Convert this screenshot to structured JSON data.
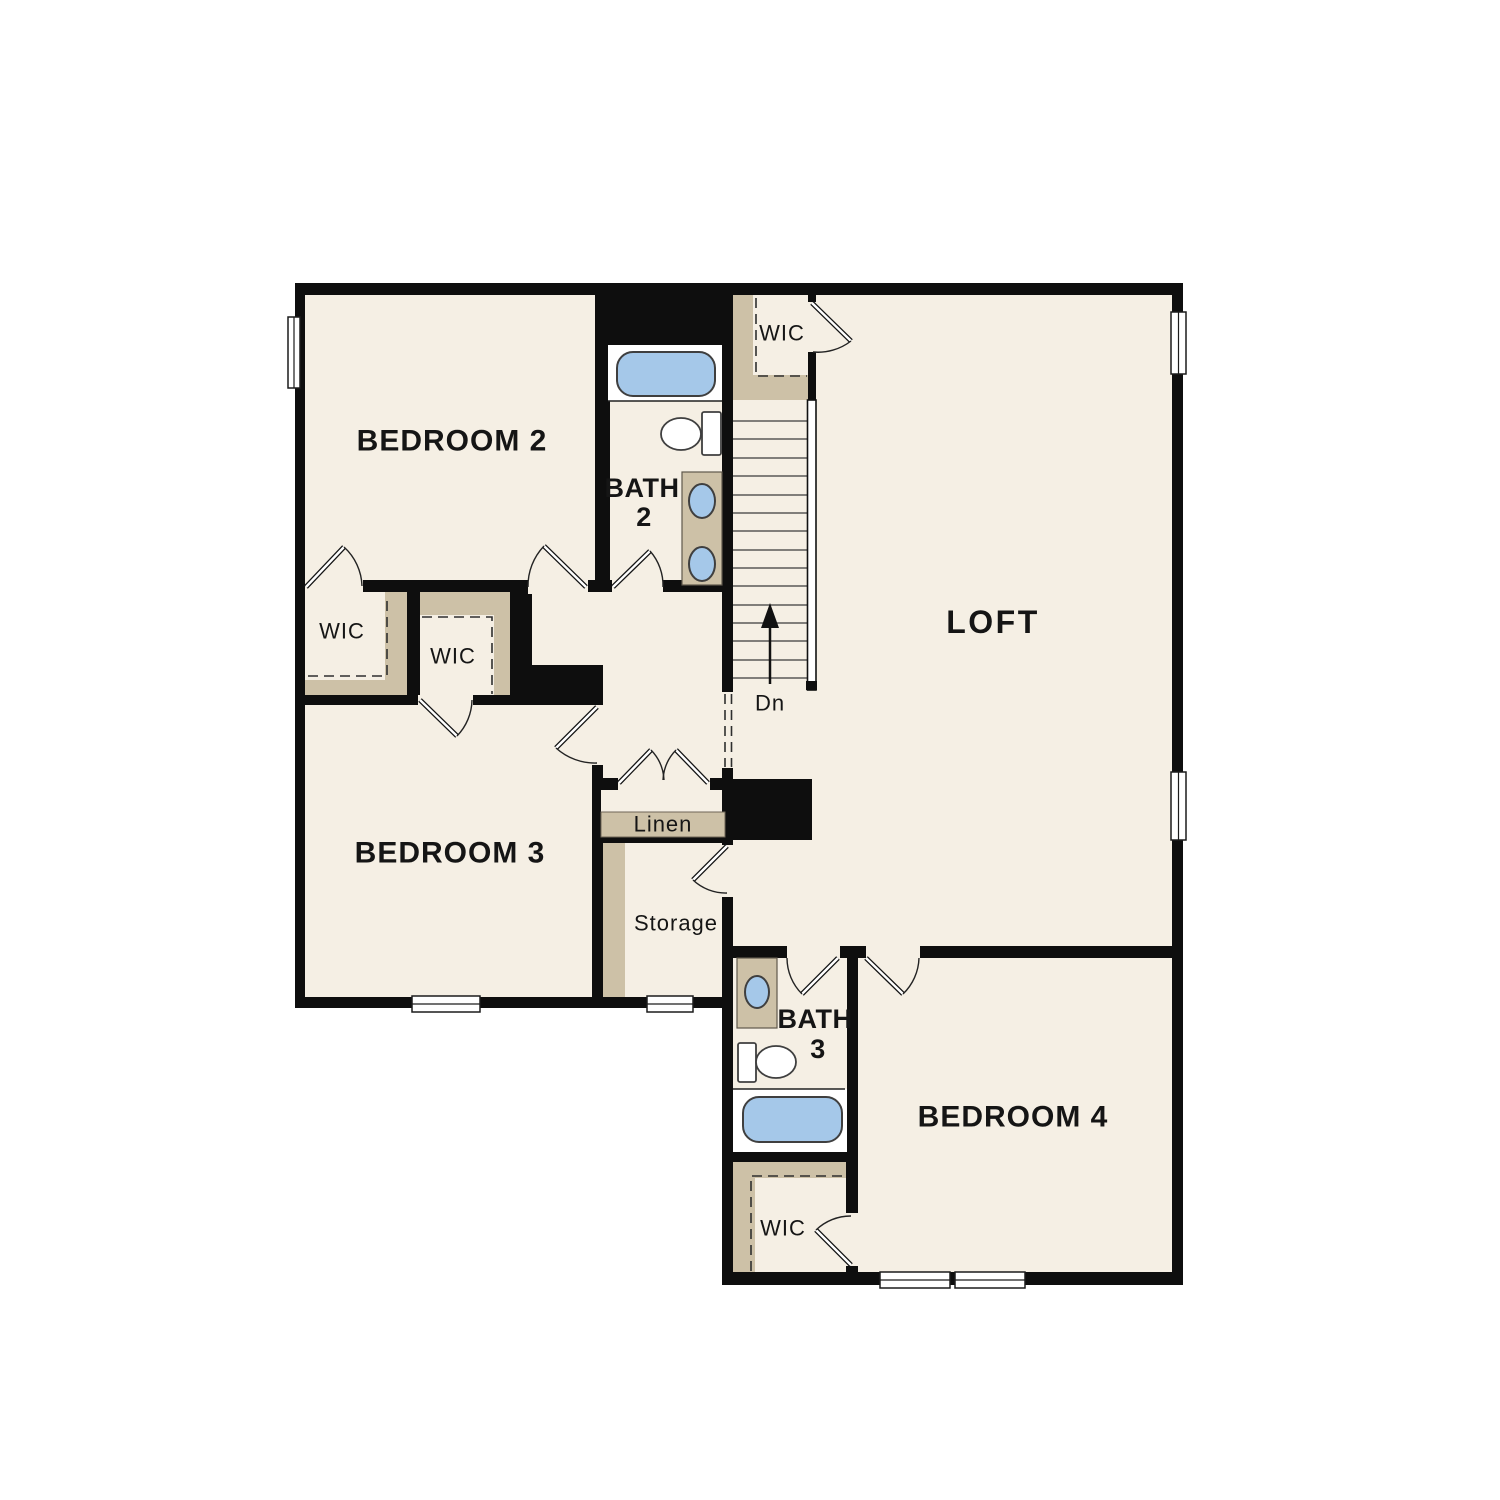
{
  "plan": {
    "rooms": [
      {
        "name": "bedroom-2",
        "label": "BEDROOM 2"
      },
      {
        "name": "bath-2",
        "label": "BATH",
        "number": "2"
      },
      {
        "name": "wic-hall",
        "label": "WIC"
      },
      {
        "name": "loft",
        "label": "LOFT"
      },
      {
        "name": "wic-bedroom3-left",
        "label": "WIC"
      },
      {
        "name": "wic-bedroom3-right",
        "label": "WIC"
      },
      {
        "name": "bedroom-3",
        "label": "BEDROOM 3"
      },
      {
        "name": "linen",
        "label": "Linen"
      },
      {
        "name": "storage",
        "label": "Storage"
      },
      {
        "name": "bath-3",
        "label": "BATH",
        "number": "3"
      },
      {
        "name": "bedroom-4",
        "label": "BEDROOM 4"
      },
      {
        "name": "wic-bedroom4",
        "label": "WIC"
      }
    ],
    "stairs": {
      "down_label": "Dn"
    },
    "colors": {
      "background": "#ffffff",
      "wall": "#0e0e0e",
      "floor": "#f5efe4",
      "closet_shelf": "#cdc1a7",
      "fixture_blue": "#a5c8e9",
      "fixture_outline": "#3f3f3f"
    }
  }
}
